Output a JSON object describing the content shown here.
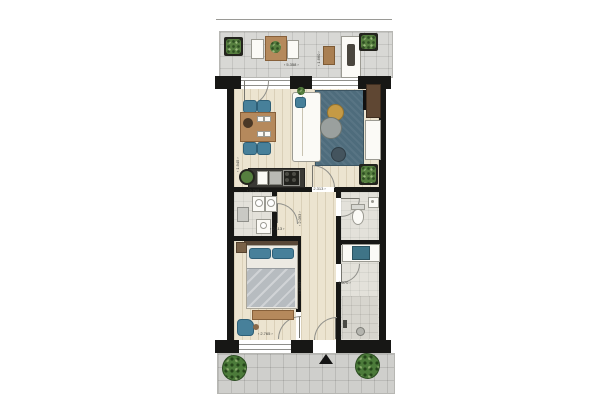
{
  "meta": {
    "description": "Architectural floor plan of an apartment with top balcony, living/dining room, kitchen, storage room, hallway, toilet, bathroom, bedroom and a lower terrace with entrance arrow"
  },
  "colors": {
    "wall": "#171715",
    "wood_floor": "#ece4d0",
    "tile_floor": "#d8d8d5",
    "rug": "#4e6c7c",
    "accent_teal": "#47809a",
    "wood_furniture": "#b5895c",
    "plant_green": "#567f3f",
    "mustard_table": "#c59a45"
  },
  "rooms": [
    {
      "name": "balcony"
    },
    {
      "name": "living-dining-room"
    },
    {
      "name": "kitchen"
    },
    {
      "name": "storage-room"
    },
    {
      "name": "hallway"
    },
    {
      "name": "toilet"
    },
    {
      "name": "bathroom"
    },
    {
      "name": "bedroom"
    },
    {
      "name": "terrace-entrance"
    }
  ],
  "dimensions": {
    "balcony_width": "5.358",
    "balcony_depth": "1.660",
    "living_side": "1.945",
    "kitchen_width": "2.765",
    "hall_top_width": "2.313",
    "storage_width": "2.113",
    "storage_depth": "2.093",
    "bedroom_length": "4.013",
    "bathroom_width": "1.070",
    "bedroom_width": "2.765"
  }
}
